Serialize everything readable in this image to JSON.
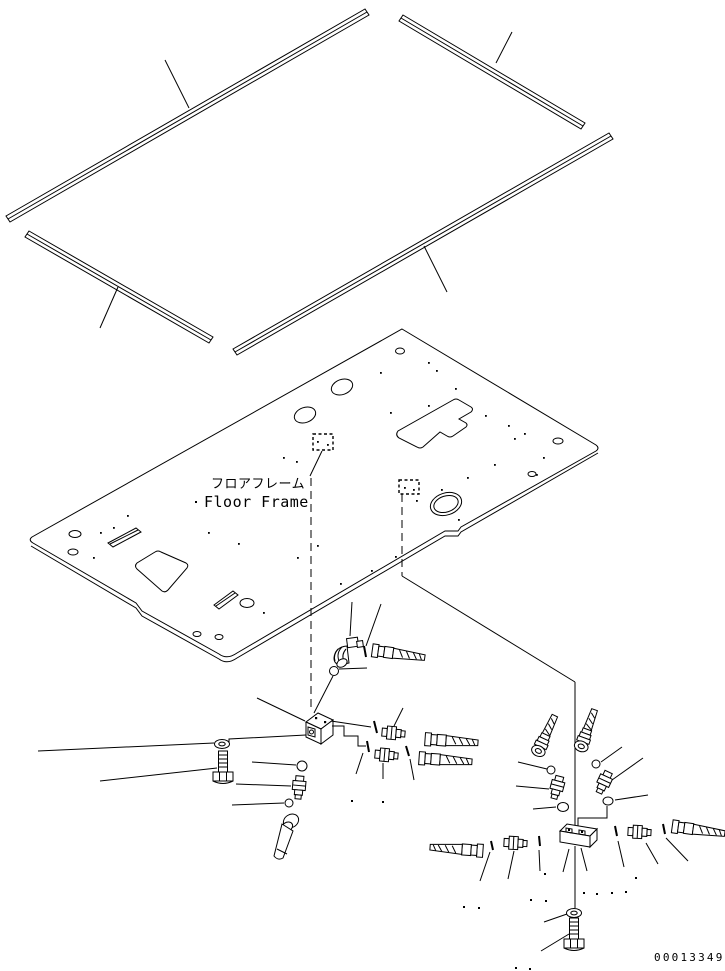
{
  "page": {
    "background": "#ffffff",
    "line_color": "#000000"
  },
  "diagram": {
    "label_ja": "フロアフレーム",
    "label_en": "Floor Frame",
    "drawing_number": "00013349"
  }
}
